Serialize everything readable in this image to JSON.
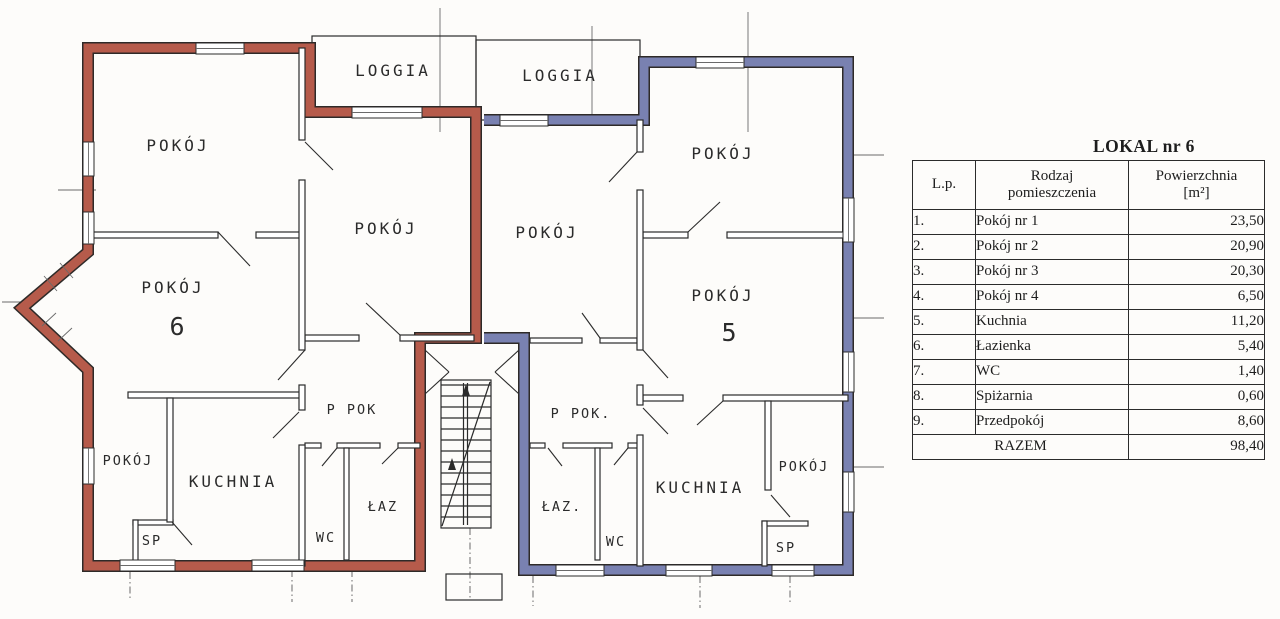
{
  "plan": {
    "unit6": {
      "number": "6",
      "outline_color": "#c2604e",
      "rooms": {
        "loggia": "LOGGIA",
        "room_top_left": "POKÓJ",
        "room_center": "POKÓJ",
        "room_main": "POKÓJ",
        "room_small": "POKÓJ",
        "kitchen": "KUCHNIA",
        "hall": "P POK",
        "bathroom": "ŁAZ",
        "wc": "WC",
        "pantry": "SP"
      }
    },
    "unit5": {
      "number": "5",
      "outline_color": "#8089bd",
      "rooms": {
        "loggia": "LOGGIA",
        "room_top_right": "POKÓJ",
        "room_center": "POKÓJ",
        "room_main": "POKÓJ",
        "room_small": "POKÓJ",
        "kitchen": "KUCHNIA",
        "hall": "P POK.",
        "bathroom": "ŁAZ.",
        "wc": "WC",
        "pantry": "SP"
      }
    }
  },
  "table": {
    "title": "LOKAL nr 6",
    "headers": {
      "lp": "L.p.",
      "type_line1": "Rodzaj",
      "type_line2": "pomieszczenia",
      "area_line1": "Powierzchnia",
      "area_line2": "[m²]"
    },
    "rows": [
      {
        "lp": "1.",
        "name": "Pokój nr 1",
        "area": "23,50"
      },
      {
        "lp": "2.",
        "name": "Pokój nr 2",
        "area": "20,90"
      },
      {
        "lp": "3.",
        "name": "Pokój nr 3",
        "area": "20,30"
      },
      {
        "lp": "4.",
        "name": "Pokój nr 4",
        "area": "6,50"
      },
      {
        "lp": "5.",
        "name": "Kuchnia",
        "area": "11,20"
      },
      {
        "lp": "6.",
        "name": "Łazienka",
        "area": "5,40"
      },
      {
        "lp": "7.",
        "name": "WC",
        "area": "1,40"
      },
      {
        "lp": "8.",
        "name": "Spiżarnia",
        "area": "0,60"
      },
      {
        "lp": "9.",
        "name": "Przedpokój",
        "area": "8,60"
      }
    ],
    "total": {
      "label": "RAZEM",
      "area": "98,40"
    }
  }
}
